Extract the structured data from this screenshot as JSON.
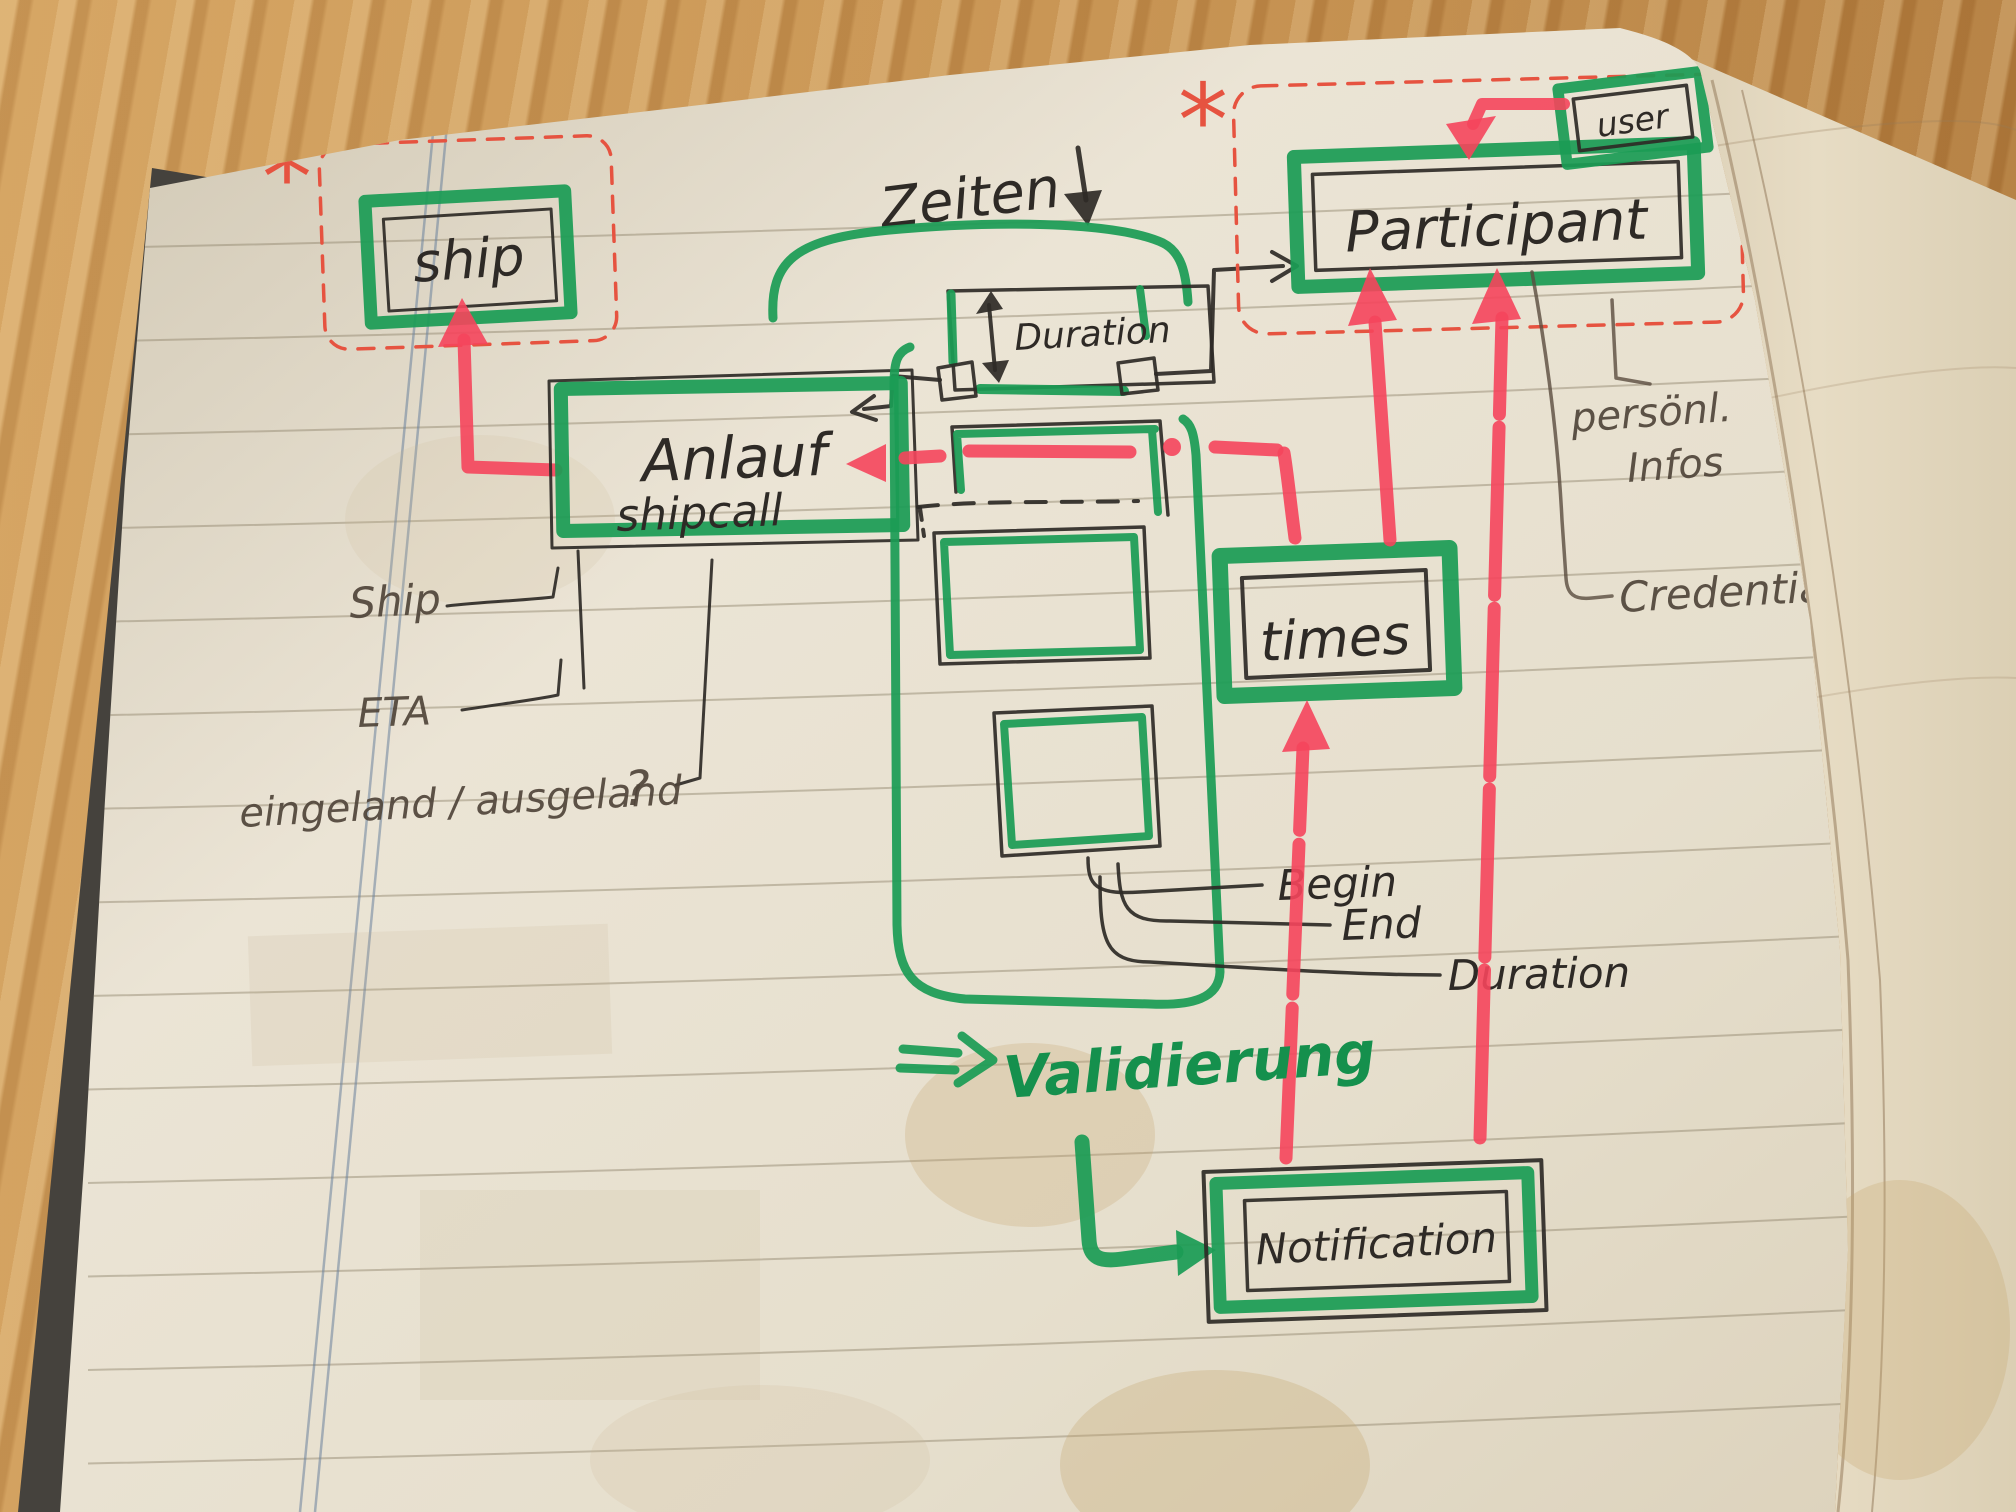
{
  "scene": {
    "description": "Hand-drawn data-model sketch on a ruled notebook page lying on a wooden desk"
  },
  "colors": {
    "marker_green": "#1b9c55",
    "marker_red": "#f5455c",
    "pen_red": "#e65340",
    "ink": "#2e2a26",
    "pencil": "#5a4c3e",
    "paper": "#e8e1d2"
  },
  "entities": {
    "ship": {
      "label": "ship",
      "starred": true
    },
    "anlauf": {
      "label": "Anlauf",
      "sublabel": "shipcall"
    },
    "duration": {
      "label": "Duration"
    },
    "participant": {
      "label": "Participant",
      "starred": true
    },
    "user": {
      "label": "user"
    },
    "times": {
      "label": "times"
    },
    "notification": {
      "label": "Notification"
    }
  },
  "labels": {
    "asterisk": "*",
    "zeiten": "Zeiten",
    "ship_attr": "Ship",
    "eta": "ETA",
    "eingeland": "eingeland / ausgeland",
    "question": "?",
    "begin": "Begin",
    "end": "End",
    "duration": "Duration",
    "validierung": "Validierung",
    "personal_1": "persönl.",
    "personal_2": "Infos",
    "credentials": "Credentials"
  }
}
